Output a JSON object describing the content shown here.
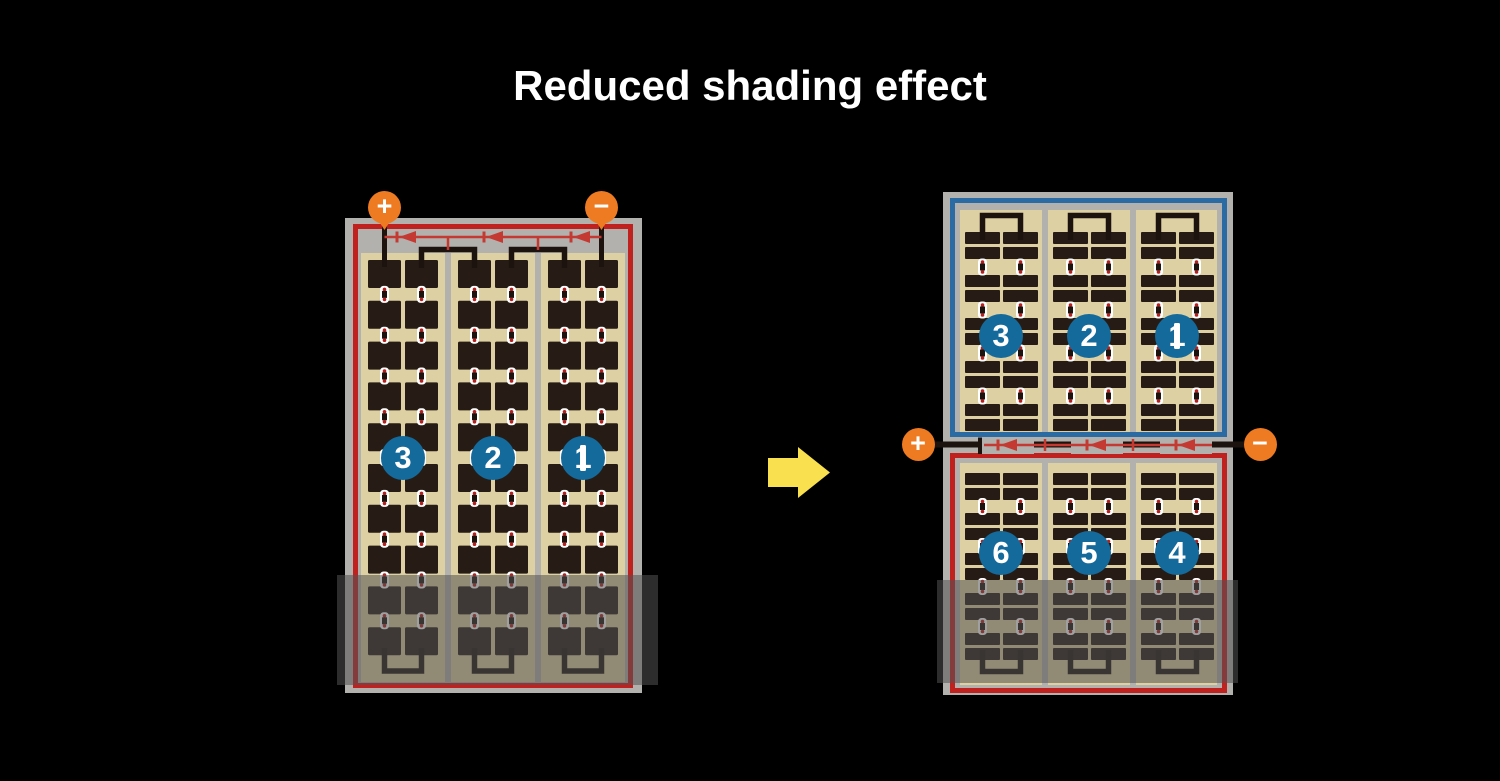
{
  "title": "Reduced shading effect",
  "colors": {
    "background": "#000000",
    "title_text": "#ffffff",
    "frame_gray": "#b3b1ae",
    "panel_tan": "#ddd0a3",
    "cell_dark": "#261c15",
    "red_border": "#c0211f",
    "blue_border": "#2a6ba3",
    "circle_blue": "#156a9c",
    "circle_text": "#ffffff",
    "terminal_orange": "#ee7b22",
    "terminal_text": "#ffffff",
    "diode_red": "#c43a32",
    "wire_black": "#1c130e",
    "connector_white": "#ffffff",
    "connector_dot_red": "#b5201e",
    "shade_overlay": "rgba(82,82,82,0.55)",
    "arrow_yellow": "#f8e04e"
  },
  "left_module": {
    "terminals": {
      "positive": "+",
      "negative": "−"
    },
    "strings": [
      {
        "label": "3"
      },
      {
        "label": "2"
      },
      {
        "label": "1"
      }
    ],
    "cell_grid": {
      "columns": 6,
      "rows": 10
    },
    "bypass_diodes": 3
  },
  "right_module": {
    "terminals": {
      "positive": "+",
      "negative": "−"
    },
    "top_half": {
      "strings": [
        {
          "label": "3"
        },
        {
          "label": "2"
        },
        {
          "label": "1"
        }
      ],
      "cell_grid": {
        "columns": 6,
        "rows": 10
      }
    },
    "bottom_half": {
      "strings": [
        {
          "label": "6"
        },
        {
          "label": "5"
        },
        {
          "label": "4"
        }
      ],
      "cell_grid": {
        "columns": 6,
        "rows": 10
      }
    },
    "bypass_diodes": 3
  }
}
